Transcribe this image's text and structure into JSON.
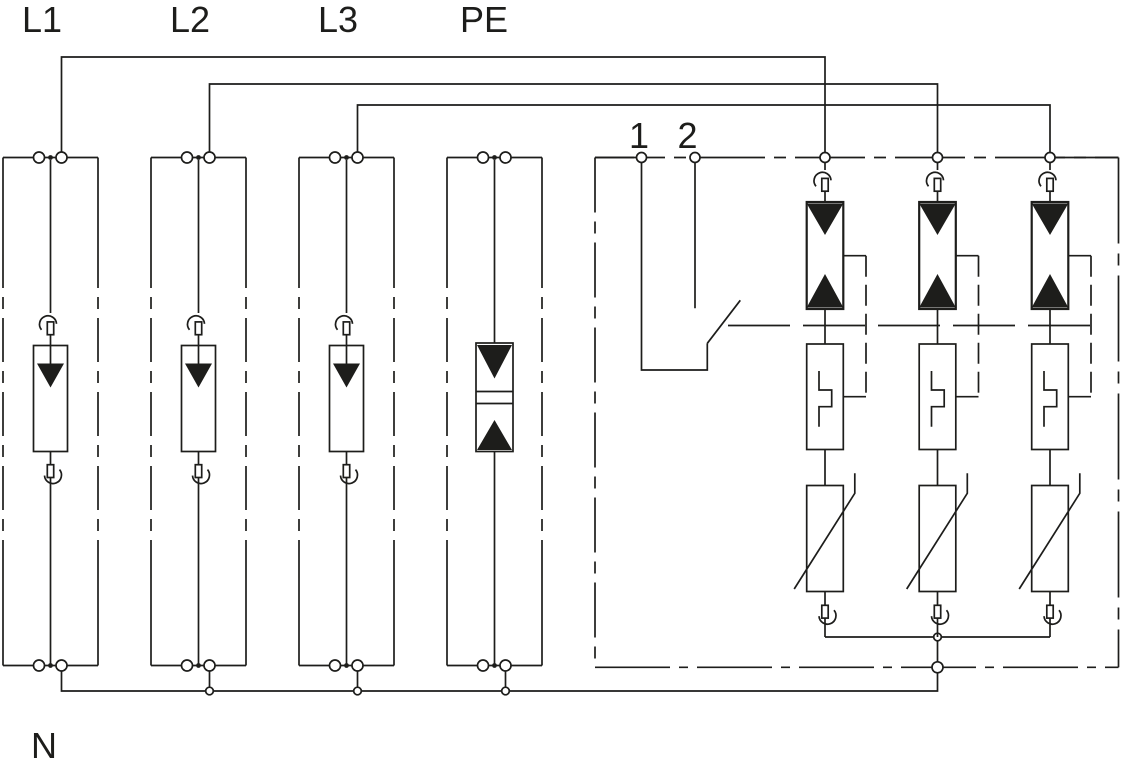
{
  "diagram": {
    "background_color": "#ffffff",
    "line_color": "#1d1d1b",
    "conductor_labels": {
      "l1": "L1",
      "l2": "L2",
      "l3": "L3",
      "pe": "PE",
      "n": "N"
    },
    "signal_contact_terminals": {
      "terminal_1": "1",
      "terminal_2": "2"
    },
    "components": {
      "phase_module_icon": "spark-gap-arrester-icon",
      "n_pe_module_icon": "gas-discharge-tube-icon",
      "branch_gap_icon": "triggered-spark-gap-icon",
      "branch_trigger_icon": "trigger-circuit-icon",
      "branch_varistor_icon": "varistor-icon",
      "disconnector_icon": "thermal-disconnector-icon",
      "switch_icon": "remote-signalling-contact-icon"
    }
  }
}
